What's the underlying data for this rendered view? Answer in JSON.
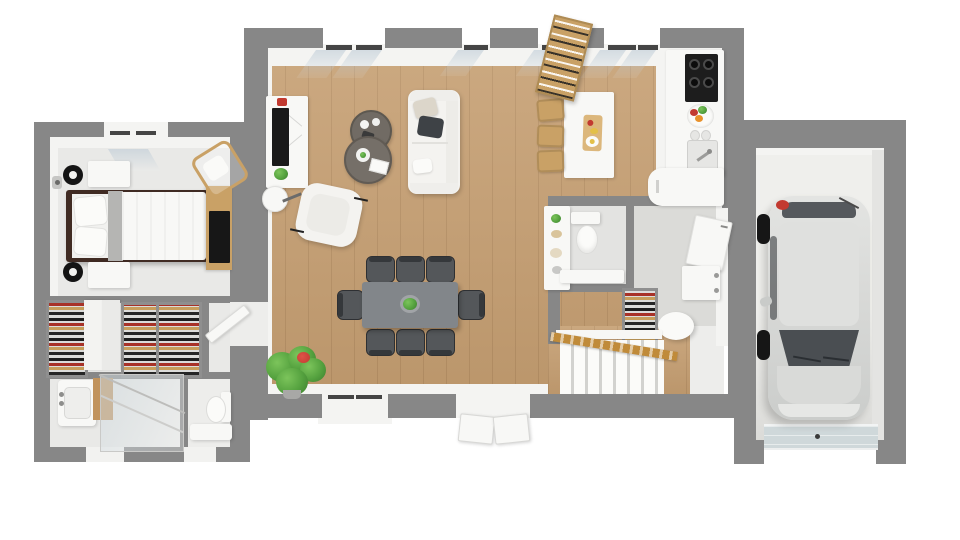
{
  "scene": {
    "kind": "3d-floor-plan-render",
    "view": "top-down",
    "description": "Photorealistic top-down 3D floor plan of a single-storey house: bedroom with closet and bathroom on the left, open living/dining/kitchen in the center, WC and hallway with stairs, and a garage with a parked car on the right."
  },
  "palette": {
    "background": "#FFFFFF",
    "wall": "#878787",
    "wall-face": "#F4F4F2",
    "wood-floor": "#C59E71",
    "room-floor": "#E9E9E7",
    "bath-floor": "#EDEDEB",
    "utility-floor": "#DBDBD8",
    "wc-floor": "#E3E3E1",
    "garage-floor": "#EFEFEC",
    "white-furniture": "#F8F8F6",
    "sofa-fabric": "#F4F3F0",
    "table-top": "#82868A",
    "chair-seat": "#54575A",
    "chair-back": "#35383B",
    "coffee-table": "#716B64",
    "bed-frame": "#402B23",
    "bed-runner": "#B5B5B3",
    "wood-furniture": "#C9A166",
    "rail-wood": "#C08B3A",
    "screen-black": "#1A1A1A",
    "cooktop-black": "#1D1D1D",
    "glass-tint": "#D7E0E6",
    "plant-green": "#55A23F",
    "plant-dark": "#3C7D2E",
    "accent-red": "#C23A30",
    "fruit-orange": "#E8912B",
    "fruit-yellow": "#E3C049",
    "car-silver": "#D8D9D7",
    "car-glass": "#4A4E52",
    "garage-door": "#CFD8DA"
  },
  "rooms": [
    {
      "name": "bedroom",
      "items": [
        "double-bed",
        "pillows",
        "gray-runner",
        "nightstand",
        "nightstand",
        "table-lamp",
        "table-lamp",
        "desk",
        "monitor",
        "desk-chair",
        "wall-sconce",
        "window"
      ]
    },
    {
      "name": "closet",
      "items": [
        "clothes-rack",
        "clothes-rack",
        "clothes-rack",
        "sliding-door-panels"
      ]
    },
    {
      "name": "bathroom",
      "items": [
        "washbasin-vanity",
        "glass-shower",
        "toilet",
        "bench"
      ]
    },
    {
      "name": "living-room",
      "items": [
        "sofa",
        "throw-pillows",
        "armchair",
        "coffee-table",
        "coffee-table",
        "tv-stand",
        "tv",
        "floor-lamp",
        "potted-plant",
        "windows"
      ]
    },
    {
      "name": "dining-area",
      "items": [
        "dining-table",
        "dining-chairs-x8",
        "centerpiece-plant",
        "sliding-window",
        "french-door"
      ]
    },
    {
      "name": "kitchen",
      "items": [
        "island",
        "bar-stools-x3",
        "cutting-board",
        "cooktop",
        "sink",
        "fruit-bowl",
        "corner-cabinet",
        "leaning-bookshelf"
      ]
    },
    {
      "name": "wc",
      "items": [
        "toilet",
        "bench",
        "display-shelf"
      ]
    },
    {
      "name": "hallway",
      "items": [
        "coat-closet-door",
        "cabinet",
        "shoe-rack",
        "ottoman",
        "staircase",
        "wood-railing"
      ]
    },
    {
      "name": "garage",
      "items": [
        "car",
        "garage-door"
      ]
    }
  ],
  "counts": {
    "dining_chairs": 8,
    "bar_stools": 3,
    "clothes_racks": 3,
    "cars": 1
  }
}
